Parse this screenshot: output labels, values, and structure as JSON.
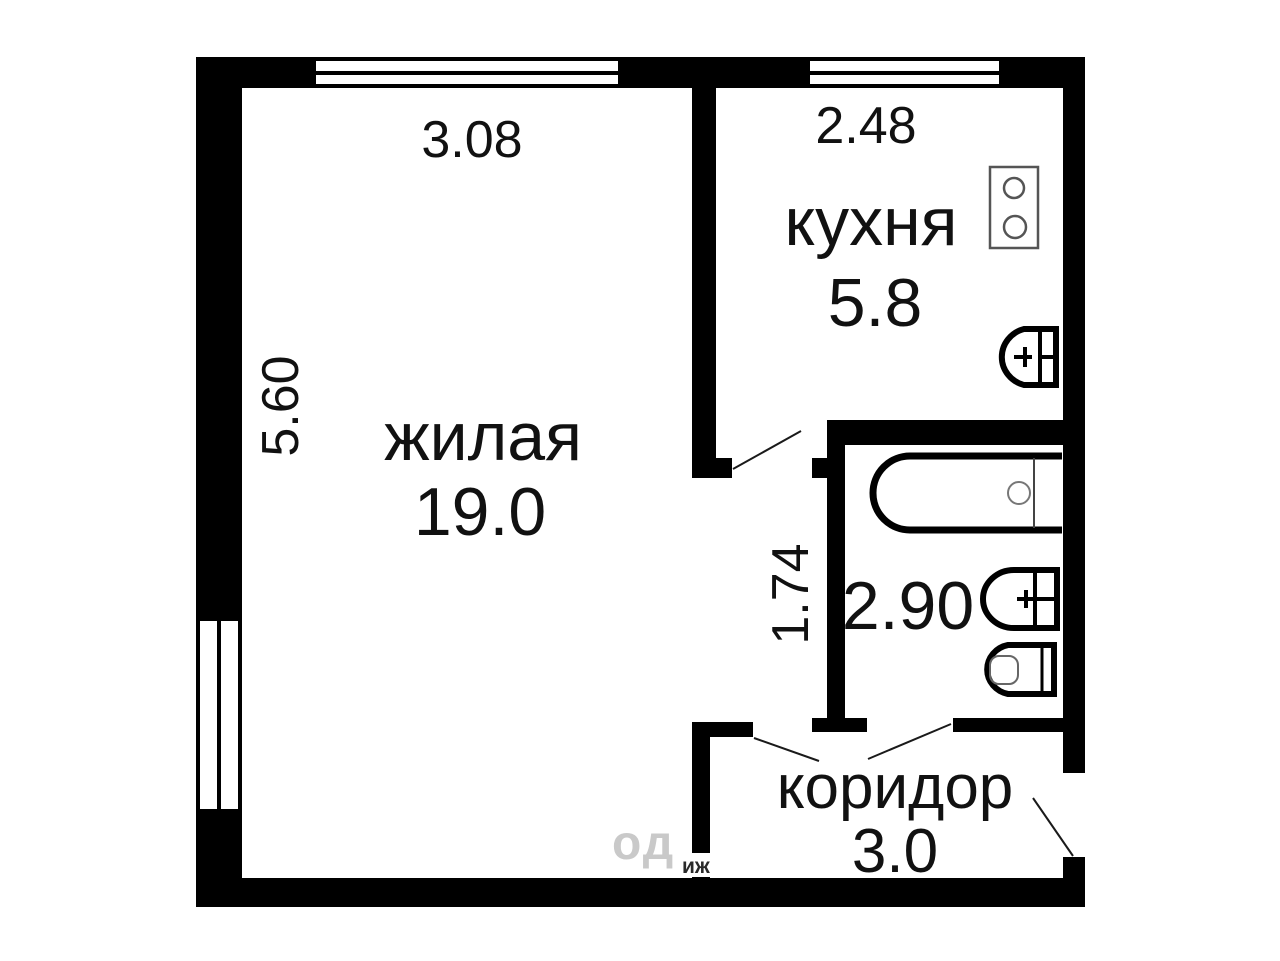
{
  "rooms": {
    "living": {
      "name": "жилая",
      "area": "19.0",
      "width_m": "3.08",
      "depth_m": "5.60"
    },
    "kitchen": {
      "name": "кухня",
      "area": "5.8",
      "width_m": "2.48"
    },
    "bathroom": {
      "area": "2.90"
    },
    "hallway": {
      "width_m": "1.74"
    },
    "corridor": {
      "name": "коридор",
      "area": "3.0"
    }
  },
  "watermark": {
    "top": "од",
    "bottom": "иж"
  },
  "colors": {
    "wall": "#000000",
    "background": "#ffffff",
    "fixture_thick": "#000000",
    "fixture_thin": "#777777",
    "door_line": "#1a1a1a",
    "watermark": "#c9c9c9"
  },
  "icons": {
    "stove": "stove-icon",
    "kitchen_sink": "kitchen-sink-icon",
    "bathtub": "bathtub-icon",
    "washbasin": "washbasin-icon",
    "toilet": "toilet-icon",
    "window": "window-glyph",
    "door_swing": "door-swing-line"
  }
}
